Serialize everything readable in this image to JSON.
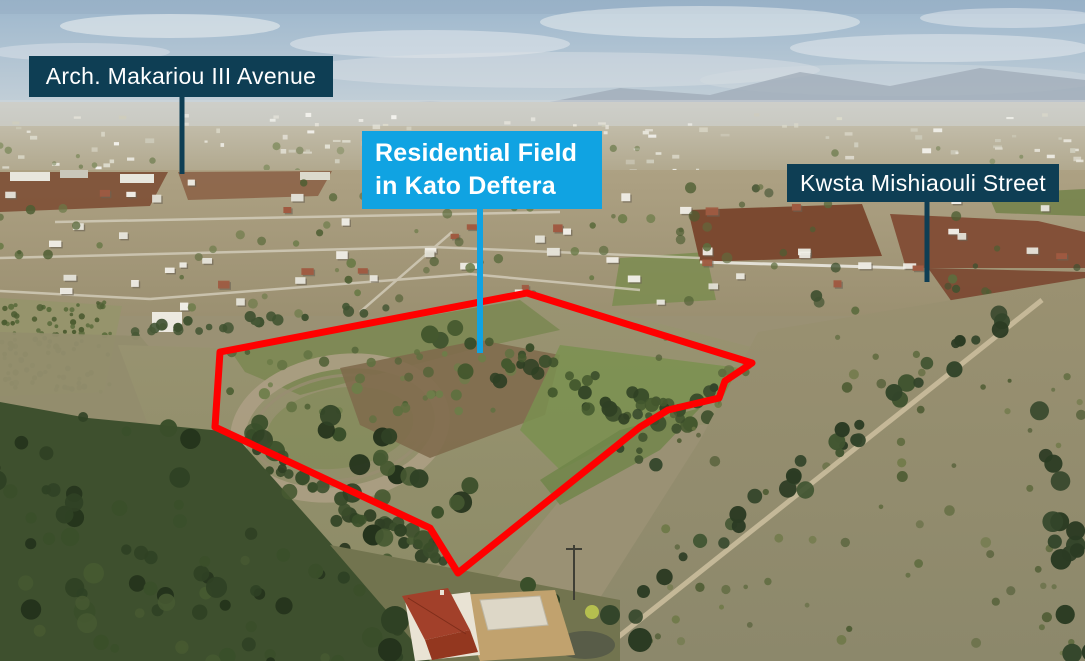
{
  "annotations": {
    "labels": [
      {
        "id": "arch-makariou-iii-avenue",
        "text": "Arch. Makariou III Avenue",
        "background": "#0e3e54",
        "text_color": "#ffffff"
      },
      {
        "id": "residential-field-kato-deftera",
        "line1": "Residential Field",
        "line2": "in Kato Deftera",
        "background": "#10a3e2",
        "text_color": "#ffffff"
      },
      {
        "id": "kwsta-mishiaouli-street",
        "text": "Kwsta Mishiaouli Street",
        "background": "#0e3e54",
        "text_color": "#ffffff"
      }
    ],
    "site_outline": {
      "color": "#ff0000",
      "points": "220,352 527,293 752,363 725,381 719,398 668,410 640,427 458,573 430,528 215,427"
    }
  }
}
